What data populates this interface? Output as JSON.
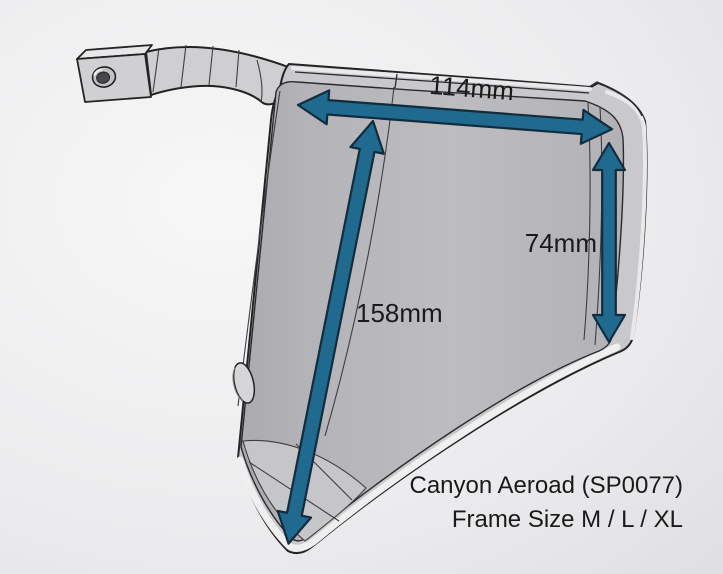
{
  "measurements": {
    "top_width": "114mm",
    "right_height": "74mm",
    "diagonal_length": "158mm"
  },
  "caption": {
    "line1": "Canyon Aeroad (SP0077)",
    "line2": "Frame Size M / L / XL"
  },
  "colors": {
    "arrow_fill": "#1f6a8e",
    "arrow_outline": "#132c3d",
    "part_fill": "#c9c9cc",
    "part_interior": "#b8b8bb",
    "part_outline": "#232323",
    "label_text": "#1a1a1a",
    "background_light": "#f7f7f7",
    "background_dark": "#d8d8da"
  }
}
